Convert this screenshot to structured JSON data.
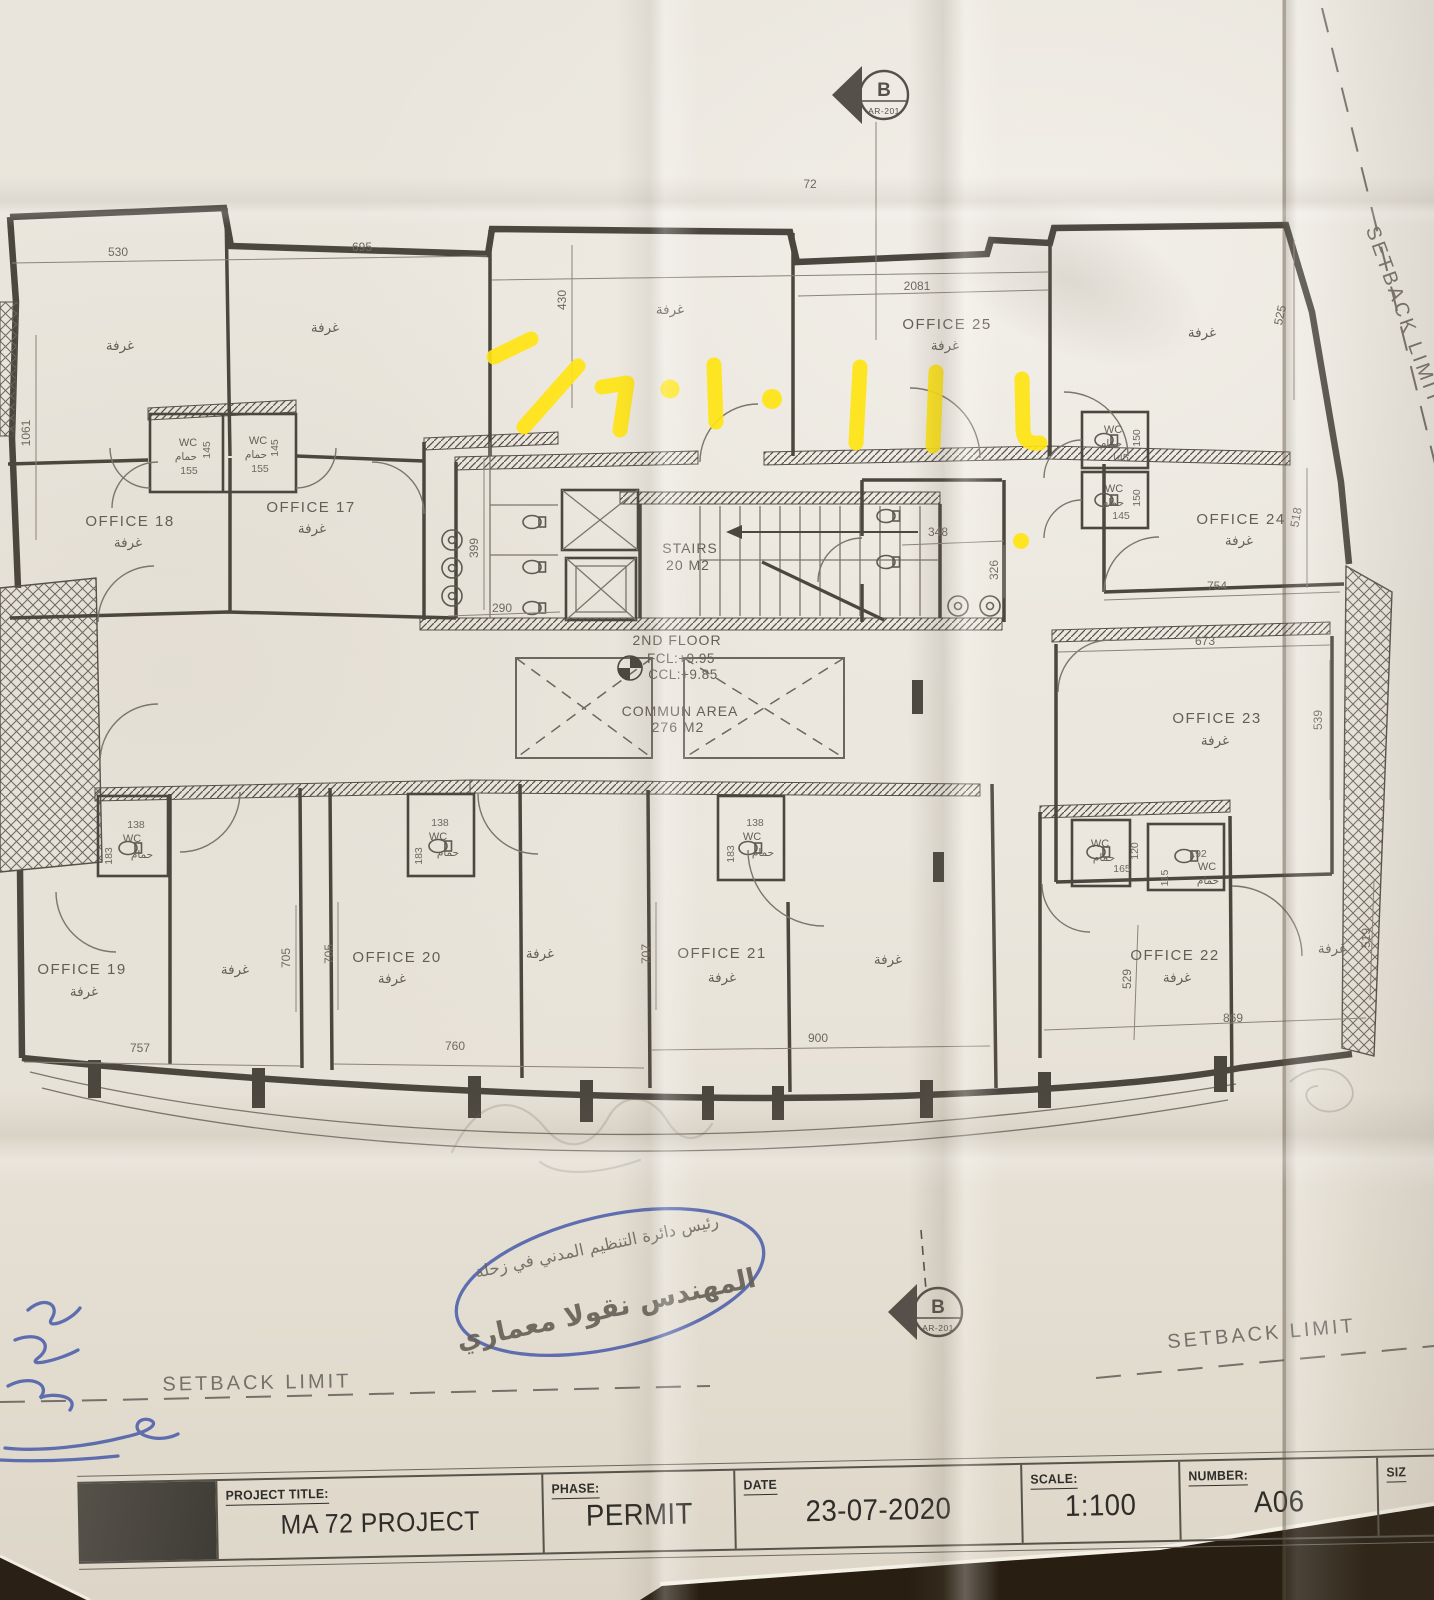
{
  "title_block": {
    "project_title_label": "PROJECT TITLE:",
    "project_title_value": "MA 72 PROJECT",
    "phase_label": "PHASE:",
    "phase_value": "PERMIT",
    "date_label": "DATE",
    "date_value": "23-07-2020",
    "scale_label": "SCALE:",
    "scale_value": "1:100",
    "number_label": "NUMBER:",
    "number_value": "A06",
    "size_label": "SIZ"
  },
  "setback_limit": "SETBACK LIMIT",
  "plan": {
    "floor_label": "2ND FLOOR",
    "fcl": "FCL:+9.95",
    "ccl": "CCL:+9.85",
    "stairs": "STAIRS",
    "stairs_area": "20 M2",
    "commun": "COMMUN AREA",
    "commun_area": "276 M2",
    "grid_number": "72",
    "marker_letter": "B",
    "marker_ref": "AR-201",
    "room_ar": "غرفة",
    "wc": "WC",
    "wc_ar": "حمام"
  },
  "offices": {
    "o17": "OFFICE 17",
    "o18": "OFFICE 18",
    "o19": "OFFICE 19",
    "o20": "OFFICE 20",
    "o21": "OFFICE 21",
    "o22": "OFFICE 22",
    "o23": "OFFICE 23",
    "o24": "OFFICE 24",
    "o25": "OFFICE 25"
  },
  "dims": {
    "d530": "530",
    "d695": "695",
    "d430": "430",
    "d2081": "2081",
    "d525": "525",
    "d1061": "1061",
    "d145": "145",
    "d155": "155",
    "d150": "150",
    "d399": "399",
    "d290": "290",
    "d348": "348",
    "d326": "326",
    "d754": "754",
    "d673": "673",
    "d518": "518",
    "d539": "539",
    "d138": "138",
    "d183": "183",
    "d705": "705",
    "d707": "707",
    "d757": "757",
    "d760": "760",
    "d900": "900",
    "d869": "869",
    "d519": "519",
    "d529": "529",
    "d120": "120",
    "d115": "115",
    "d192": "192",
    "d165": "165"
  },
  "stamp": {
    "line1": "رئيس دائرة التنظيم المدني في زحلة",
    "line2": "المهندس نقولا معماري"
  },
  "colors": {
    "highlighter": "#ffe412",
    "ink": "#3c51a6",
    "plan_line": "#4b473f"
  }
}
